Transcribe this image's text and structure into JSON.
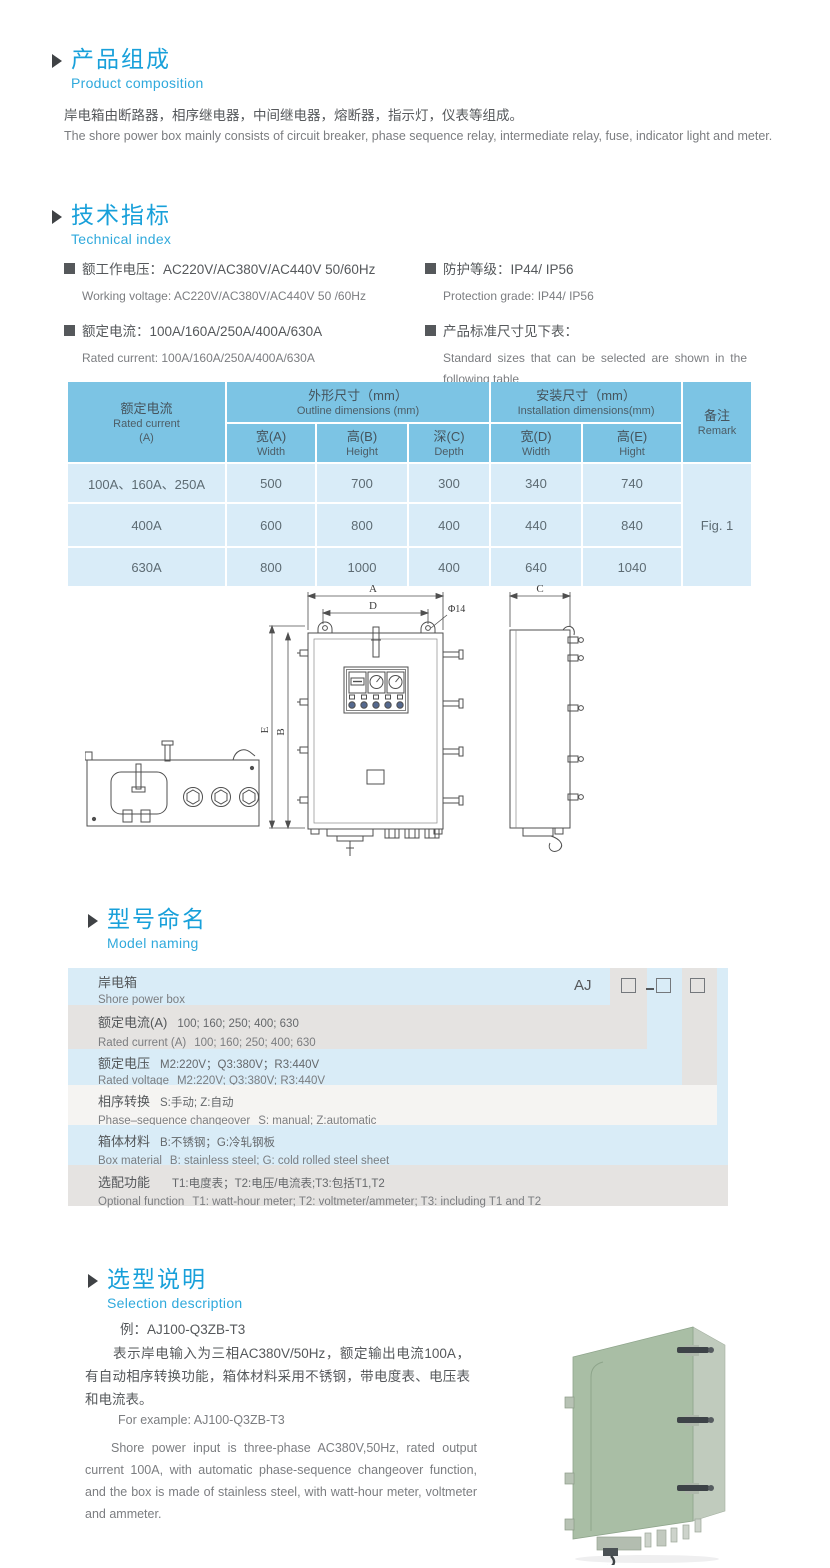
{
  "colors": {
    "accent_blue": "#18a0da",
    "subtitle_blue": "#2fa9dc",
    "table_header_bg": "#7cc4e4",
    "table_row_bg": "#d9ecf8",
    "model_row_blue": "#d9ecf7",
    "model_row_gray": "#e5e3e1",
    "text_dark": "#55585b",
    "text_gray": "#7b7d80",
    "photo_green": "#a9bea5"
  },
  "product_composition": {
    "title_cn": "产品组成",
    "title_en": "Product  composition",
    "body_cn": "岸电箱由断路器，相序继电器，中间继电器，熔断器，指示灯，仪表等组成。",
    "body_en": "The shore power box mainly consists of circuit breaker, phase sequence relay, intermediate relay, fuse, indicator light and meter."
  },
  "technical_index": {
    "title_cn": "技术指标",
    "title_en": "Technical index",
    "items": [
      {
        "cn": "额工作电压：AC220V/AC380V/AC440V  50/60Hz",
        "en": "Working voltage: AC220V/AC380V/AC440V 50 /60Hz"
      },
      {
        "cn": "额定电流：100A/160A/250A/400A/630A",
        "en": "Rated current: 100A/160A/250A/400A/630A"
      },
      {
        "cn": "防护等级：IP44/ IP56",
        "en": "Protection grade: IP44/ IP56"
      },
      {
        "cn": "产品标准尺寸见下表：",
        "en": "Standard sizes that can be selected are shown in the following table"
      }
    ]
  },
  "size_table": {
    "col1_cn": "额定电流",
    "col1_en": "Rated current",
    "col1_unit": "(A)",
    "group1_cn": "外形尺寸（mm）",
    "group1_en": "Outline dimensions (mm)",
    "group2_cn": "安装尺寸（mm）",
    "group2_en": "Installation dimensions(mm)",
    "remark_cn": "备注",
    "remark_en": "Remark",
    "subcols": [
      {
        "cn": "宽(A)",
        "en": "Width"
      },
      {
        "cn": "高(B)",
        "en": "Height"
      },
      {
        "cn": "深(C)",
        "en": "Depth"
      },
      {
        "cn": "宽(D)",
        "en": "Width"
      },
      {
        "cn": "高(E)",
        "en": "Hight"
      }
    ],
    "rows": [
      {
        "current": "100A、160A、250A",
        "v": [
          "500",
          "700",
          "300",
          "340",
          "740"
        ]
      },
      {
        "current": "400A",
        "v": [
          "600",
          "800",
          "400",
          "440",
          "840"
        ]
      },
      {
        "current": "630A",
        "v": [
          "800",
          "1000",
          "400",
          "640",
          "1040"
        ]
      }
    ],
    "remark_value": "Fig. 1"
  },
  "drawing": {
    "labels": {
      "a": "A",
      "d": "D",
      "phi": "Φ14",
      "e": "E",
      "b": "B",
      "c": "C"
    }
  },
  "model_naming": {
    "title_cn": "型号命名",
    "title_en": "Model naming",
    "code_prefix": "AJ",
    "rows": [
      {
        "cn_label": "岸电箱",
        "cn_text": "",
        "en_label": "Shore power box",
        "en_text": ""
      },
      {
        "cn_label": "额定电流(A)",
        "cn_text": "100; 160; 250; 400; 630",
        "en_label": "Rated current (A)",
        "en_text": "100; 160; 250; 400; 630"
      },
      {
        "cn_label": "额定电压",
        "cn_text": "M2:220V；Q3:380V；R3:440V",
        "en_label": "Rated voltage",
        "en_text": "M2:220V;  Q3:380V;  R3:440V"
      },
      {
        "cn_label": "相序转换",
        "cn_text": "S:手动; Z:自动",
        "en_label": "Phase–sequence changeover",
        "en_text": "S: manual;  Z:automatic"
      },
      {
        "cn_label": "箱体材料",
        "cn_text": "B:不锈钢；G:冷轧钢板",
        "en_label": "Box material",
        "en_text": "B: stainless steel; G: cold rolled steel sheet"
      },
      {
        "cn_label": "选配功能",
        "cn_text": "T1:电度表；T2:电压/电流表;T3:包括T1,T2",
        "en_label": "Optional function",
        "en_text": "T1: watt-hour meter; T2: voltmeter/ammeter; T3: including T1 and T2"
      }
    ]
  },
  "selection": {
    "title_cn": "选型说明",
    "title_en": "Selection description",
    "example_cn": "例：AJ100-Q3ZB-T3",
    "para_cn": "表示岸电输入为三相AC380V/50Hz，额定输出电流100A，有自动相序转换功能，箱体材料采用不锈钢，带电度表、电压表和电流表。",
    "example_en": "For example: AJ100-Q3ZB-T3",
    "para_en": "Shore power input is three-phase AC380V,50Hz, rated output current 100A, with automatic phase-sequence changeover function, and the box is made of stainless steel, with watt-hour meter, voltmeter and ammeter."
  }
}
